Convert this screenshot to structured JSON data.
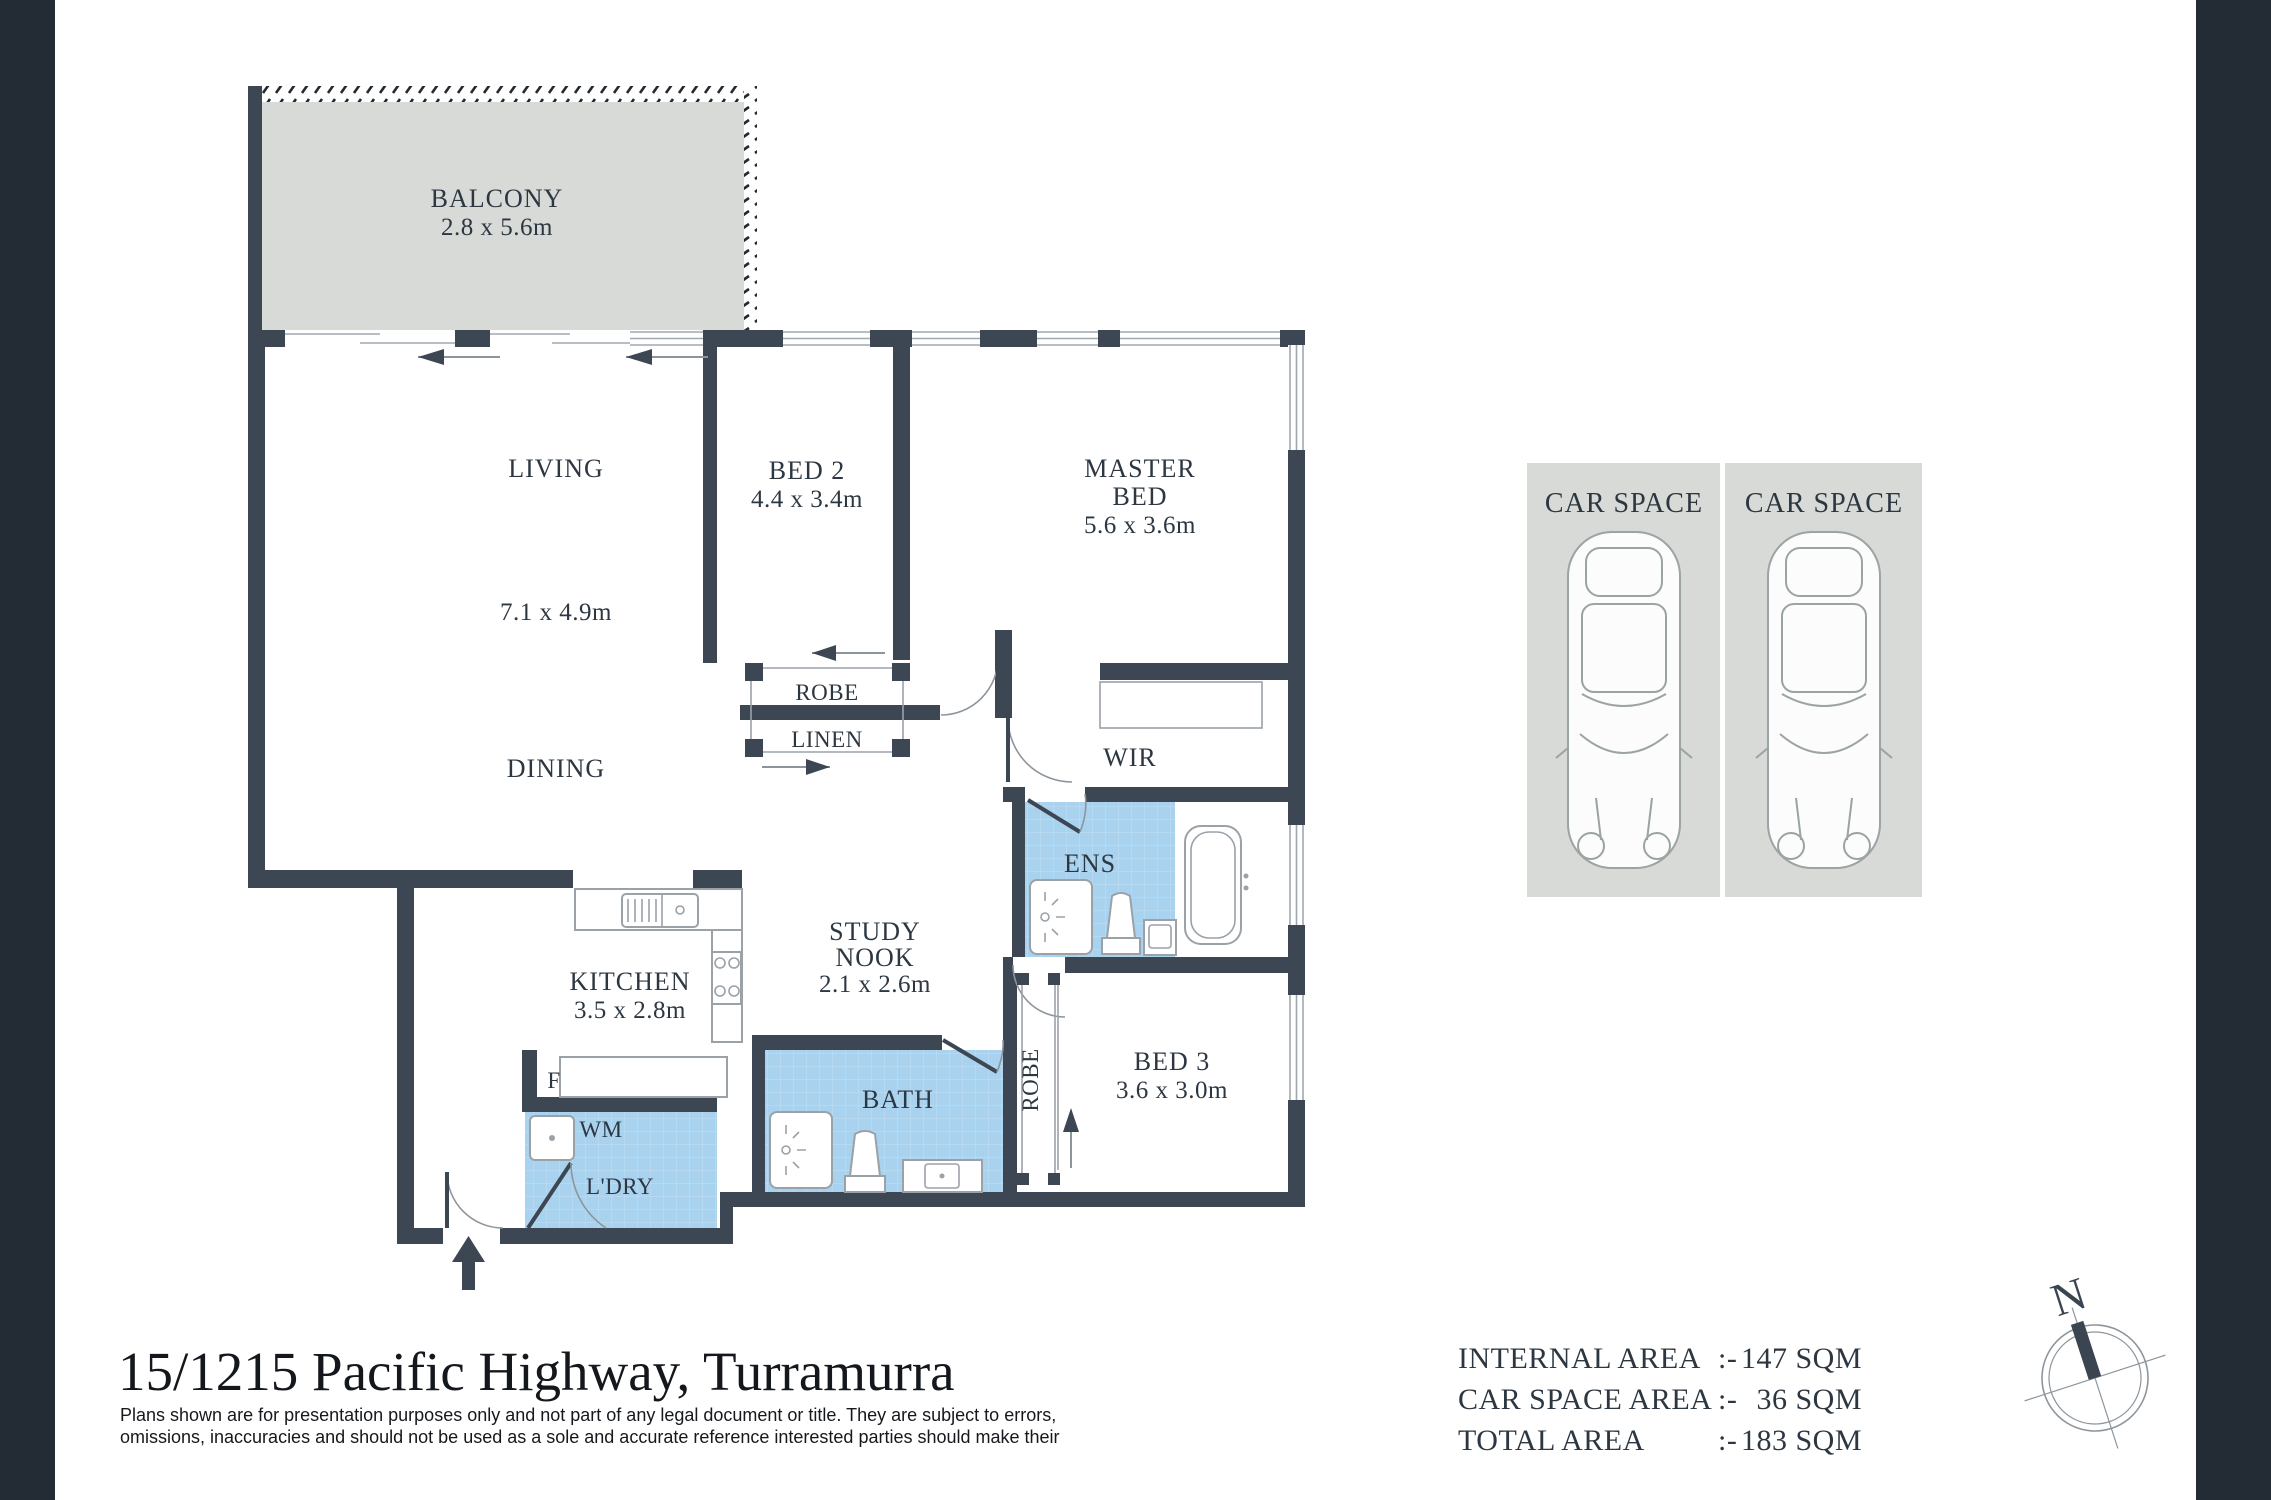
{
  "title": {
    "address": "15/1215 Pacific Highway, Turramurra",
    "disclaimer_line1": "Plans shown are for presentation purposes only and not part of any legal document or title. They are subject to errors,",
    "disclaimer_line2": "omissions, inaccuracies and should not be used as a sole and accurate reference interested parties should make their"
  },
  "areas": {
    "internal_label": "INTERNAL AREA",
    "internal_sep": ":-",
    "internal_value": "147 SQM",
    "car_label": "CAR SPACE AREA",
    "car_sep": ":-",
    "car_value": "36 SQM",
    "total_label": "TOTAL AREA",
    "total_sep": ":-",
    "total_value": "183 SQM"
  },
  "rooms": {
    "balcony": {
      "name": "BALCONY",
      "dims": "2.8 x 5.6m"
    },
    "living": {
      "name": "LIVING",
      "dims": "7.1 x 4.9m"
    },
    "dining": {
      "name": "DINING"
    },
    "bed2": {
      "name": "BED 2",
      "dims": "4.4 x 3.4m"
    },
    "master": {
      "name_line1": "MASTER",
      "name_line2": "BED",
      "dims": "5.6 x 3.6m"
    },
    "robe": {
      "name": "ROBE"
    },
    "linen": {
      "name": "LINEN"
    },
    "wir": {
      "name": "WIR"
    },
    "ens": {
      "name": "ENS"
    },
    "study": {
      "name_line1": "STUDY",
      "name_line2": "NOOK",
      "dims": "2.1 x 2.6m"
    },
    "kitchen": {
      "name": "KITCHEN",
      "dims": "3.5 x 2.8m"
    },
    "fridge": {
      "label": "F"
    },
    "laundry": {
      "wm_label": "WM",
      "name": "L'DRY"
    },
    "bath": {
      "name": "BATH"
    },
    "bed3": {
      "name": "BED 3",
      "dims": "3.6 x 3.0m",
      "robe_label": "ROBE"
    }
  },
  "car_area": {
    "space1_label": "CAR SPACE",
    "space2_label": "CAR SPACE"
  },
  "compass": {
    "north": "N"
  },
  "colors": {
    "sidebar": "#232b34",
    "wall": "#3d4754",
    "outdoor_grey": "#d7dad6",
    "tile_blue": "#a9d2ee",
    "tile_grid": "#c3e0f4",
    "label_text": "#2d3742"
  }
}
